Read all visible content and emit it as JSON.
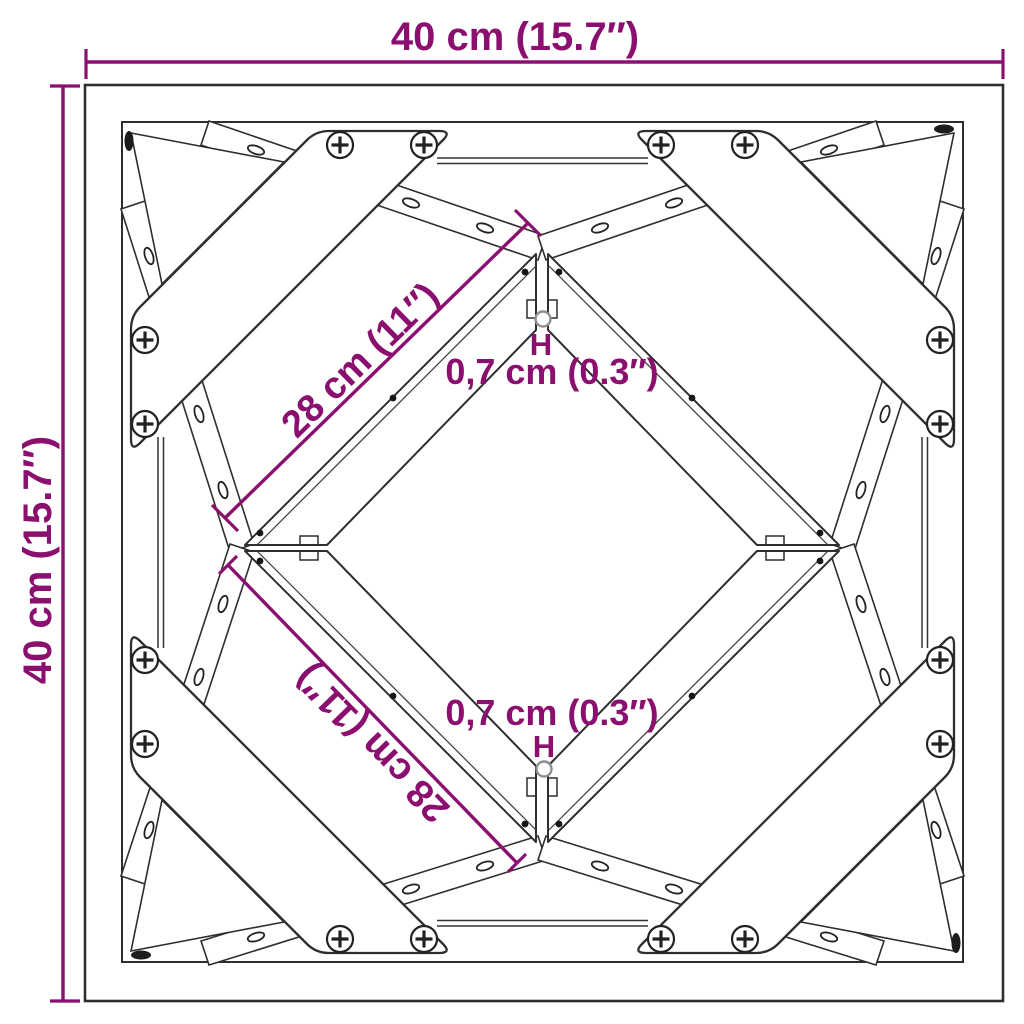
{
  "figure": {
    "type": "product-dimension-diagram",
    "annotations": {
      "width_top": "40 cm (15.7″)",
      "height_left": "40 cm (15.7″)",
      "diagonal_upper": "28 cm (11″)",
      "diagonal_lower": "28 cm (11″)",
      "hole_top": "0,7 cm (0.3″)",
      "hole_bottom": "0,7 cm (0.3″)",
      "hole_marker_top": "H",
      "hole_marker_bottom": "H"
    },
    "colors": {
      "dimension_accent": "#8B0F6F",
      "line_color": "#2E2E2E",
      "hole_outline": "#8F8F8F",
      "background": "#FFFFFF"
    }
  }
}
